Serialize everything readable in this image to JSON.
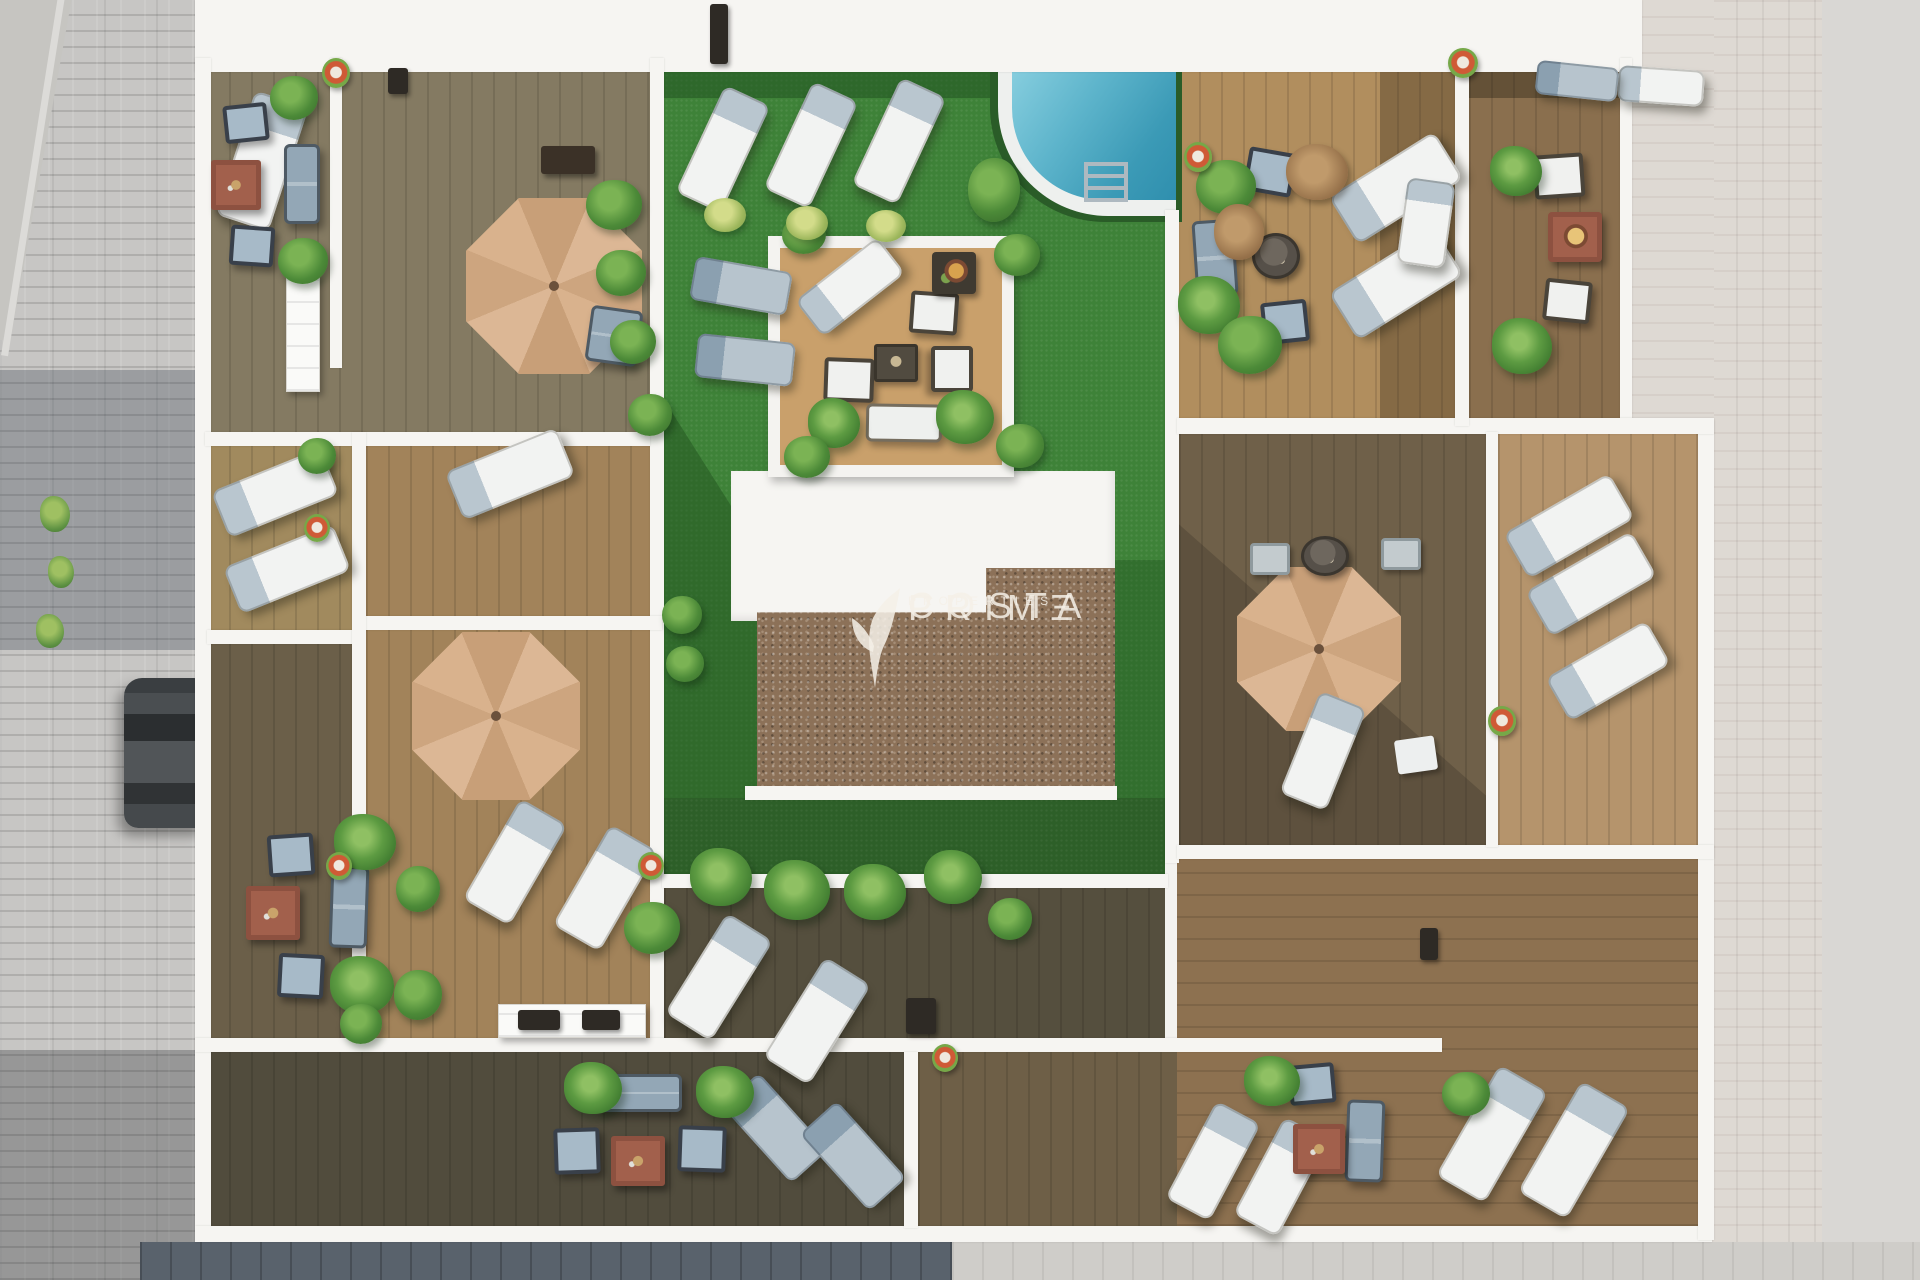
{
  "watermark": {
    "line1": "COSTA",
    "line2": "PRIMΞ",
    "line3": "PROPERTIES",
    "logo": "leaf-sprig-icon"
  },
  "palette": {
    "lawn": "#3e8238",
    "lawn_shadow": "#1e4d1d",
    "pool_water_light": "#85cadb",
    "pool_water_dark": "#3b9ab6",
    "umbrella_tan": "#d7b18c",
    "wall_white": "#f6f5f2",
    "gravel_brown": "#8c7158",
    "wood_dark_olive": "#847a62",
    "wood_medium": "#a2835a",
    "wood_light": "#c9a06b",
    "street_gray": "#a3a5a7",
    "street_pale": "#ded9d3",
    "street_slate": "#59626c",
    "terracotta": "#a2604c",
    "furniture_blue": "#a7bac8",
    "lounger_white": "#f2f3f2"
  },
  "scene": {
    "items": [
      {
        "t": "umbrella",
        "n": "patio-umbrella",
        "x": 466,
        "y": 198,
        "w": 176,
        "h": 176
      },
      {
        "t": "umbrella",
        "n": "patio-umbrella",
        "x": 412,
        "y": 632,
        "w": 168,
        "h": 168
      },
      {
        "t": "umbrella",
        "n": "patio-umbrella",
        "x": 1237,
        "y": 567,
        "w": 164,
        "h": 164
      },
      {
        "t": "lounger-w",
        "n": "sun-lounger",
        "x": 234,
        "y": 96,
        "w": 56,
        "h": 130,
        "r": 18
      },
      {
        "t": "lounger-w",
        "n": "sun-lounger",
        "x": 450,
        "y": 448,
        "w": 120,
        "h": 52,
        "r": -22,
        "v": "h"
      },
      {
        "t": "lounger-w",
        "n": "sun-lounger",
        "x": 216,
        "y": 468,
        "w": 118,
        "h": 50,
        "r": -22,
        "v": "h"
      },
      {
        "t": "lounger-w",
        "n": "sun-lounger",
        "x": 228,
        "y": 544,
        "w": 118,
        "h": 50,
        "r": -22,
        "v": "h"
      },
      {
        "t": "lounger-w",
        "n": "sun-lounger",
        "x": 698,
        "y": 90,
        "w": 50,
        "h": 118,
        "r": 25
      },
      {
        "t": "lounger-w",
        "n": "sun-lounger",
        "x": 786,
        "y": 86,
        "w": 50,
        "h": 118,
        "r": 25
      },
      {
        "t": "lounger-w",
        "n": "sun-lounger",
        "x": 874,
        "y": 82,
        "w": 50,
        "h": 118,
        "r": 25
      },
      {
        "t": "lounger-w",
        "n": "sun-lounger",
        "x": 488,
        "y": 804,
        "w": 54,
        "h": 116,
        "r": 30
      },
      {
        "t": "lounger-w",
        "n": "sun-lounger",
        "x": 578,
        "y": 830,
        "w": 54,
        "h": 116,
        "r": 30
      },
      {
        "t": "lounger-w",
        "n": "sun-lounger",
        "x": 692,
        "y": 918,
        "w": 54,
        "h": 118,
        "r": 32
      },
      {
        "t": "lounger-w",
        "n": "sun-lounger",
        "x": 790,
        "y": 962,
        "w": 54,
        "h": 118,
        "r": 32
      },
      {
        "t": "lounger-w",
        "n": "sun-lounger",
        "x": 1334,
        "y": 160,
        "w": 124,
        "h": 56,
        "r": -32,
        "v": "h"
      },
      {
        "t": "lounger-w",
        "n": "sun-lounger",
        "x": 1334,
        "y": 256,
        "w": 124,
        "h": 56,
        "r": -32,
        "v": "h"
      },
      {
        "t": "lounger-w",
        "n": "sun-lounger",
        "x": 1508,
        "y": 500,
        "w": 122,
        "h": 52,
        "r": -30,
        "v": "h"
      },
      {
        "t": "lounger-w",
        "n": "sun-lounger",
        "x": 1530,
        "y": 558,
        "w": 122,
        "h": 52,
        "r": -30,
        "v": "h"
      },
      {
        "t": "lounger-w",
        "n": "sun-lounger",
        "x": 1550,
        "y": 646,
        "w": 116,
        "h": 50,
        "r": -30,
        "v": "h"
      },
      {
        "t": "lounger-w",
        "n": "sun-lounger",
        "x": 1464,
        "y": 1070,
        "w": 56,
        "h": 128,
        "r": 30
      },
      {
        "t": "lounger-w",
        "n": "sun-lounger",
        "x": 1546,
        "y": 1086,
        "w": 56,
        "h": 128,
        "r": 30
      },
      {
        "t": "lounger-w",
        "n": "sun-lounger",
        "x": 1298,
        "y": 696,
        "w": 50,
        "h": 110,
        "r": 22
      },
      {
        "t": "lounger-w",
        "n": "sun-lounger",
        "x": 1188,
        "y": 1106,
        "w": 50,
        "h": 110,
        "r": 28
      },
      {
        "t": "lounger-w",
        "n": "sun-lounger",
        "x": 1256,
        "y": 1122,
        "w": 50,
        "h": 110,
        "r": 28
      },
      {
        "t": "lounger-w",
        "n": "sun-lounger",
        "x": 798,
        "y": 264,
        "w": 104,
        "h": 46,
        "r": -38,
        "v": "h"
      },
      {
        "t": "lounger-w",
        "n": "sun-lounger",
        "x": 1402,
        "y": 180,
        "w": 48,
        "h": 86,
        "r": 8
      },
      {
        "t": "lounger-w",
        "n": "sun-lounger",
        "x": 1618,
        "y": 68,
        "w": 86,
        "h": 36,
        "r": 4,
        "v": "h"
      },
      {
        "t": "lounger-g",
        "n": "sun-lounger-gray",
        "x": 692,
        "y": 264,
        "w": 98,
        "h": 44,
        "r": 10,
        "v": "h"
      },
      {
        "t": "lounger-g",
        "n": "sun-lounger-gray",
        "x": 696,
        "y": 338,
        "w": 98,
        "h": 44,
        "r": 6,
        "v": "h"
      },
      {
        "t": "lounger-g",
        "n": "sun-lounger-gray",
        "x": 750,
        "y": 1076,
        "w": 50,
        "h": 104,
        "r": -42
      },
      {
        "t": "lounger-g",
        "n": "sun-lounger-gray",
        "x": 828,
        "y": 1104,
        "w": 50,
        "h": 104,
        "r": -42
      },
      {
        "t": "lounger-g",
        "n": "sun-lounger-gray",
        "x": 1536,
        "y": 64,
        "w": 82,
        "h": 34,
        "r": 6,
        "v": "h"
      },
      {
        "t": "chair-w",
        "n": "armchair-white",
        "x": 910,
        "y": 292,
        "w": 48,
        "h": 42,
        "r": 4
      },
      {
        "t": "chair-w",
        "n": "armchair-white",
        "x": 824,
        "y": 358,
        "w": 50,
        "h": 44,
        "r": 2
      },
      {
        "t": "chair-w",
        "n": "armchair-white",
        "x": 929,
        "y": 348,
        "w": 46,
        "h": 42,
        "r": 90
      },
      {
        "t": "chair-w",
        "n": "armchair-white",
        "x": 1534,
        "y": 154,
        "w": 50,
        "h": 44,
        "r": -4
      },
      {
        "t": "chair-w",
        "n": "armchair-white",
        "x": 1544,
        "y": 280,
        "w": 47,
        "h": 42,
        "r": 6
      },
      {
        "t": "chair-b",
        "n": "armchair-blue",
        "x": 224,
        "y": 104,
        "w": 44,
        "h": 38,
        "r": -6
      },
      {
        "t": "chair-b",
        "n": "armchair-blue",
        "x": 230,
        "y": 226,
        "w": 44,
        "h": 40,
        "r": 4
      },
      {
        "t": "chair-b",
        "n": "armchair-blue",
        "x": 268,
        "y": 834,
        "w": 46,
        "h": 42,
        "r": -4
      },
      {
        "t": "chair-b",
        "n": "armchair-blue",
        "x": 278,
        "y": 954,
        "w": 46,
        "h": 44,
        "r": 3
      },
      {
        "t": "chair-b",
        "n": "armchair-blue",
        "x": 554,
        "y": 1128,
        "w": 46,
        "h": 46,
        "r": -2
      },
      {
        "t": "chair-b",
        "n": "armchair-blue",
        "x": 678,
        "y": 1126,
        "w": 48,
        "h": 46,
        "r": 2
      },
      {
        "t": "chair-b",
        "n": "armchair-blue",
        "x": 1246,
        "y": 150,
        "w": 48,
        "h": 44,
        "r": 10
      },
      {
        "t": "chair-b",
        "n": "armchair-blue",
        "x": 1262,
        "y": 301,
        "w": 46,
        "h": 42,
        "r": -6
      },
      {
        "t": "chair-b",
        "n": "armchair-blue",
        "x": 1289,
        "y": 1064,
        "w": 46,
        "h": 40,
        "r": -5
      },
      {
        "t": "chair-g",
        "n": "chair-gray",
        "x": 1381,
        "y": 538,
        "w": 40,
        "h": 32
      },
      {
        "t": "chair-g",
        "n": "chair-gray",
        "x": 1250,
        "y": 543,
        "w": 40,
        "h": 32
      },
      {
        "t": "sofa-g",
        "n": "outdoor-sofa",
        "x": 284,
        "y": 144,
        "w": 36,
        "h": 80
      },
      {
        "t": "sofa-g",
        "n": "outdoor-sofa",
        "x": 330,
        "y": 866,
        "w": 38,
        "h": 82,
        "r": 2
      },
      {
        "t": "sofa-g",
        "n": "outdoor-sofa",
        "x": 596,
        "y": 1074,
        "w": 86,
        "h": 38
      },
      {
        "t": "sofa-g",
        "n": "outdoor-sofa",
        "x": 1194,
        "y": 220,
        "w": 42,
        "h": 76,
        "r": -4
      },
      {
        "t": "sofa-g",
        "n": "outdoor-sofa",
        "x": 1346,
        "y": 1100,
        "w": 38,
        "h": 82,
        "r": 2
      },
      {
        "t": "sofa-g",
        "n": "outdoor-sofa",
        "x": 588,
        "y": 308,
        "w": 52,
        "h": 56,
        "r": 8
      },
      {
        "t": "sofa-w",
        "n": "outdoor-sofa-white",
        "x": 866,
        "y": 404,
        "w": 76,
        "h": 38,
        "r": 1
      },
      {
        "t": "table-t",
        "n": "coffee-table-terracotta",
        "x": 211,
        "y": 160,
        "w": 50,
        "h": 50
      },
      {
        "t": "table-t",
        "n": "coffee-table-terracotta",
        "x": 246,
        "y": 886,
        "w": 54,
        "h": 54
      },
      {
        "t": "table-t",
        "n": "coffee-table-terracotta",
        "x": 611,
        "y": 1136,
        "w": 54,
        "h": 50
      },
      {
        "t": "table-t",
        "n": "coffee-table-terracotta",
        "x": 1293,
        "y": 1124,
        "w": 52,
        "h": 50
      },
      {
        "t": "fire-t",
        "n": "fire-pit-table",
        "x": 1548,
        "y": 212,
        "w": 54,
        "h": 50
      },
      {
        "t": "fire-d",
        "n": "fire-pit-table",
        "x": 932,
        "y": 252,
        "w": 44,
        "h": 42
      },
      {
        "t": "table-d",
        "n": "coffee-table-dark",
        "x": 874,
        "y": 344,
        "w": 44,
        "h": 38
      },
      {
        "t": "table-rd",
        "n": "round-table",
        "x": 1252,
        "y": 233,
        "w": 48,
        "h": 46
      },
      {
        "t": "table-rd",
        "n": "round-table",
        "x": 1301,
        "y": 536,
        "w": 48,
        "h": 40
      },
      {
        "t": "counter-w",
        "n": "outdoor-counter",
        "x": 286,
        "y": 274,
        "w": 34,
        "h": 118
      },
      {
        "t": "counter-w",
        "n": "skylight-panel",
        "x": 498,
        "y": 1004,
        "w": 148,
        "h": 34
      },
      {
        "t": "bench-d",
        "n": "bench",
        "x": 541,
        "y": 146,
        "w": 54,
        "h": 28
      },
      {
        "t": "fixture-d",
        "n": "light-fixture",
        "x": 388,
        "y": 68,
        "w": 20,
        "h": 26
      },
      {
        "t": "fixture-d",
        "n": "light-fixture",
        "x": 710,
        "y": 4,
        "w": 18,
        "h": 60
      },
      {
        "t": "fixture-d",
        "n": "grill-unit",
        "x": 906,
        "y": 998,
        "w": 30,
        "h": 36
      },
      {
        "t": "fixture-d",
        "n": "light-fixture",
        "x": 1420,
        "y": 928,
        "w": 18,
        "h": 32
      },
      {
        "t": "fixture-d",
        "n": "vent-panel",
        "x": 518,
        "y": 1010,
        "w": 42,
        "h": 20
      },
      {
        "t": "fixture-d",
        "n": "vent-panel",
        "x": 582,
        "y": 1010,
        "w": 38,
        "h": 20
      },
      {
        "t": "ladder",
        "n": "pool-ladder",
        "x": 1084,
        "y": 162,
        "w": 44,
        "h": 40
      },
      {
        "t": "mat-w",
        "n": "deck-mat",
        "x": 1396,
        "y": 738,
        "w": 40,
        "h": 34,
        "r": -8
      },
      {
        "t": "palm",
        "n": "palm-plant",
        "x": 808,
        "y": 398,
        "w": 52,
        "h": 50
      },
      {
        "t": "palm",
        "n": "palm-plant",
        "x": 936,
        "y": 390,
        "w": 58,
        "h": 54
      },
      {
        "t": "palm",
        "n": "palm-plant",
        "x": 334,
        "y": 814,
        "w": 62,
        "h": 56
      },
      {
        "t": "palm",
        "n": "palm-plant",
        "x": 330,
        "y": 956,
        "w": 64,
        "h": 58
      },
      {
        "t": "palm",
        "n": "palm-plant",
        "x": 564,
        "y": 1062,
        "w": 58,
        "h": 52
      },
      {
        "t": "palm",
        "n": "palm-plant",
        "x": 696,
        "y": 1066,
        "w": 58,
        "h": 52
      },
      {
        "t": "palm",
        "n": "palm-plant",
        "x": 1244,
        "y": 1056,
        "w": 56,
        "h": 50
      },
      {
        "t": "palm",
        "n": "palm-plant",
        "x": 1490,
        "y": 146,
        "w": 52,
        "h": 50
      },
      {
        "t": "palm",
        "n": "palm-plant",
        "x": 1492,
        "y": 318,
        "w": 60,
        "h": 56
      },
      {
        "t": "palm",
        "n": "palm-plant",
        "x": 1178,
        "y": 276,
        "w": 62,
        "h": 58
      },
      {
        "t": "palm",
        "n": "palm-plant",
        "x": 690,
        "y": 848,
        "w": 62,
        "h": 58
      },
      {
        "t": "palm",
        "n": "palm-plant",
        "x": 764,
        "y": 860,
        "w": 66,
        "h": 60
      },
      {
        "t": "palm",
        "n": "palm-plant",
        "x": 844,
        "y": 864,
        "w": 62,
        "h": 56
      },
      {
        "t": "palm",
        "n": "palm-plant",
        "x": 924,
        "y": 850,
        "w": 58,
        "h": 54
      },
      {
        "t": "bush",
        "n": "planter-bush",
        "x": 270,
        "y": 76,
        "w": 48,
        "h": 44
      },
      {
        "t": "bush",
        "n": "planter-bush",
        "x": 278,
        "y": 238,
        "w": 50,
        "h": 46
      },
      {
        "t": "bush",
        "n": "planter-bush",
        "x": 298,
        "y": 438,
        "w": 38,
        "h": 36
      },
      {
        "t": "bush",
        "n": "planter-bush",
        "x": 340,
        "y": 1004,
        "w": 42,
        "h": 40
      },
      {
        "t": "bush",
        "n": "potted-plant",
        "x": 396,
        "y": 866,
        "w": 44,
        "h": 46
      },
      {
        "t": "bush",
        "n": "potted-plant",
        "x": 394,
        "y": 970,
        "w": 48,
        "h": 50
      },
      {
        "t": "bush",
        "n": "planter-bush",
        "x": 586,
        "y": 180,
        "w": 56,
        "h": 50
      },
      {
        "t": "bush",
        "n": "planter-bush",
        "x": 596,
        "y": 250,
        "w": 50,
        "h": 46
      },
      {
        "t": "bush",
        "n": "planter-bush",
        "x": 610,
        "y": 320,
        "w": 46,
        "h": 44
      },
      {
        "t": "bush",
        "n": "planter-bush",
        "x": 628,
        "y": 394,
        "w": 44,
        "h": 42
      },
      {
        "t": "bush",
        "n": "planter-bush",
        "x": 782,
        "y": 216,
        "w": 44,
        "h": 38
      },
      {
        "t": "bush",
        "n": "planter-bush",
        "x": 994,
        "y": 234,
        "w": 46,
        "h": 42
      },
      {
        "t": "bush",
        "n": "planter-bush",
        "x": 996,
        "y": 424,
        "w": 48,
        "h": 44
      },
      {
        "t": "bush",
        "n": "planter-bush",
        "x": 784,
        "y": 436,
        "w": 46,
        "h": 42
      },
      {
        "t": "bush",
        "n": "planter-bush",
        "x": 968,
        "y": 158,
        "w": 52,
        "h": 64
      },
      {
        "t": "bush",
        "n": "planter-bush",
        "x": 1196,
        "y": 160,
        "w": 60,
        "h": 54
      },
      {
        "t": "bush",
        "n": "planter-bush",
        "x": 1218,
        "y": 316,
        "w": 64,
        "h": 58
      },
      {
        "t": "bush",
        "n": "planter-bush",
        "x": 988,
        "y": 898,
        "w": 44,
        "h": 42
      },
      {
        "t": "bush",
        "n": "planter-bush",
        "x": 1442,
        "y": 1072,
        "w": 48,
        "h": 44
      },
      {
        "t": "bush",
        "n": "planter-bush",
        "x": 662,
        "y": 596,
        "w": 40,
        "h": 38
      },
      {
        "t": "bush",
        "n": "planter-bush",
        "x": 666,
        "y": 646,
        "w": 38,
        "h": 36
      },
      {
        "t": "bush",
        "n": "planter-bush",
        "x": 624,
        "y": 902,
        "w": 56,
        "h": 52
      },
      {
        "t": "bush-l",
        "n": "light-bush",
        "x": 704,
        "y": 198,
        "w": 42,
        "h": 34
      },
      {
        "t": "bush-l",
        "n": "light-bush",
        "x": 786,
        "y": 206,
        "w": 42,
        "h": 34
      },
      {
        "t": "bush-l",
        "n": "light-bush",
        "x": 866,
        "y": 210,
        "w": 40,
        "h": 32
      },
      {
        "t": "dried",
        "n": "dried-plant",
        "x": 1286,
        "y": 144,
        "w": 62,
        "h": 56
      },
      {
        "t": "dried",
        "n": "dried-plant",
        "x": 1214,
        "y": 204,
        "w": 50,
        "h": 56
      },
      {
        "t": "pot",
        "n": "flower-pot",
        "x": 322,
        "y": 58,
        "w": 28,
        "h": 30
      },
      {
        "t": "pot",
        "n": "flower-pot",
        "x": 304,
        "y": 514,
        "w": 26,
        "h": 28
      },
      {
        "t": "pot",
        "n": "flower-pot",
        "x": 326,
        "y": 852,
        "w": 26,
        "h": 28
      },
      {
        "t": "pot",
        "n": "flower-pot",
        "x": 638,
        "y": 852,
        "w": 26,
        "h": 28
      },
      {
        "t": "pot",
        "n": "flower-pot",
        "x": 932,
        "y": 1044,
        "w": 26,
        "h": 28
      },
      {
        "t": "pot",
        "n": "flower-pot",
        "x": 1488,
        "y": 706,
        "w": 28,
        "h": 30
      },
      {
        "t": "pot",
        "n": "flower-pot",
        "x": 1184,
        "y": 142,
        "w": 28,
        "h": 30
      },
      {
        "t": "pot",
        "n": "flower-pot",
        "x": 1448,
        "y": 48,
        "w": 30,
        "h": 30
      },
      {
        "t": "weed",
        "n": "street-weed",
        "x": 40,
        "y": 496,
        "w": 30,
        "h": 36
      },
      {
        "t": "weed",
        "n": "street-weed",
        "x": 48,
        "y": 556,
        "w": 26,
        "h": 32
      },
      {
        "t": "weed",
        "n": "street-weed",
        "x": 36,
        "y": 614,
        "w": 28,
        "h": 34
      }
    ]
  }
}
